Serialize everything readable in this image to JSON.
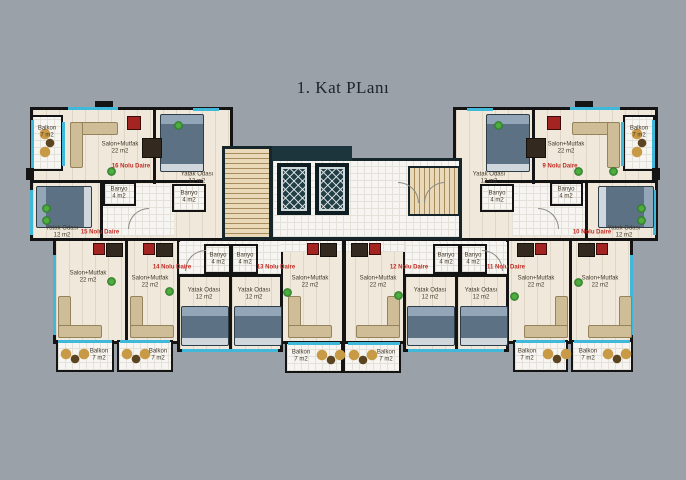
{
  "title": "1. Kat PLanı",
  "rooms": {
    "salon": {
      "name": "Salon+Mutfak",
      "area": "22 m2"
    },
    "bedroom": {
      "name": "Yatak Odası",
      "area": "12 m2"
    },
    "bath": {
      "name": "Banyo",
      "area": "4 m2"
    },
    "balcony": {
      "name": "Balkon",
      "area": "7 m2"
    }
  },
  "apartments": [
    {
      "label": "9 Nolu Daire"
    },
    {
      "label": "10 Nolu Daire"
    },
    {
      "label": "11 Nolu Daire"
    },
    {
      "label": "12 Nolu Daire"
    },
    {
      "label": "13 Nolu Daire"
    },
    {
      "label": "14 Nolu Daire"
    },
    {
      "label": "15 Nolu Daire"
    },
    {
      "label": "16 Nolu Daire"
    }
  ],
  "colors": {
    "background": "#9aa1a8",
    "wall": "#141414",
    "floor": "#f0e9db",
    "tile": "#f6f5f1",
    "window_accent": "#3fb8da",
    "apartment_label": "#c22a22",
    "elevator_core": "#223f48",
    "stairs": "#ead9b8",
    "plant": "#3f9a3f",
    "bed": "#5d7185",
    "sofa": "#cfbd97"
  }
}
